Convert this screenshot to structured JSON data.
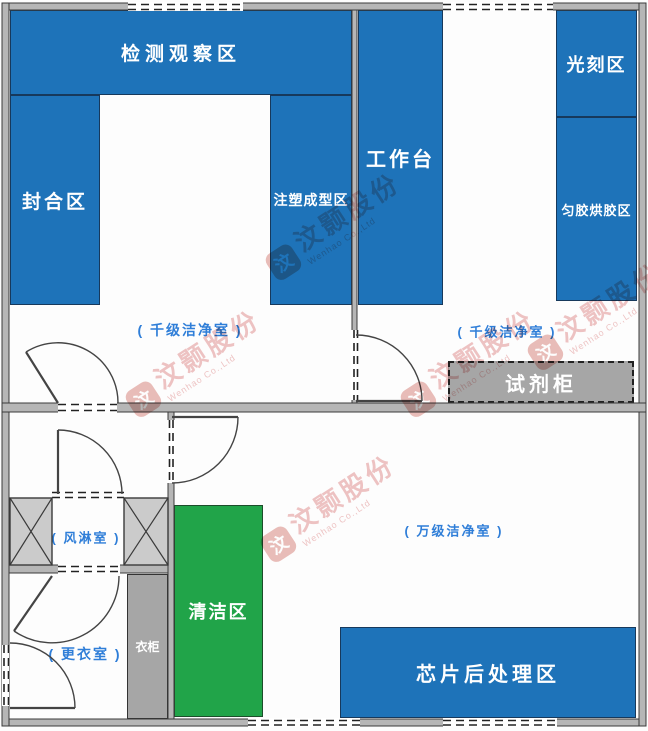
{
  "colors": {
    "zone_blue": "#1e73b9",
    "zone_green": "#21a449",
    "cabinet_gray": "#a6a6a6",
    "wall_gray": "#b6b6b6",
    "label_blue": "#2f7ed8",
    "watermark_red": "#cf4b4b"
  },
  "zones": {
    "inspection": {
      "label": "检测观察区"
    },
    "sealing": {
      "label": "封合区"
    },
    "injection": {
      "label": "注塑成型区"
    },
    "workbench": {
      "label": "工作台"
    },
    "lithography": {
      "label": "光刻区"
    },
    "coating": {
      "label": "匀胶烘胶区"
    },
    "reagent_cabinet": {
      "label": "试剂柜"
    },
    "cleaning": {
      "label": "清洁区"
    },
    "wardrobe": {
      "label": "衣柜"
    },
    "chip_post_processing": {
      "label": "芯片后处理区"
    }
  },
  "room_labels": {
    "k_class_left": "( 千级洁净室 )",
    "k_class_right": "( 千级洁净室 )",
    "air_shower": "( 风淋室 )",
    "w_class": "( 万级洁净室 )",
    "changing_room": "( 更衣室 )"
  },
  "watermark": {
    "logo_char": "汶",
    "text": "汶颢股份",
    "subtext": "Wenhao Co.,Ltd"
  }
}
